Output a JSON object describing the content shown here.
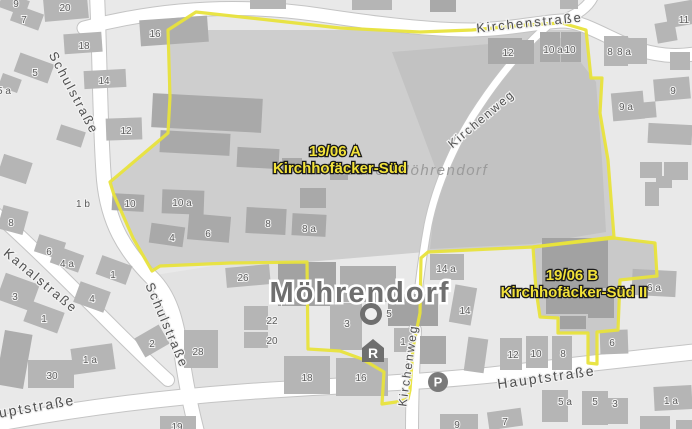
{
  "map": {
    "palette": {
      "background": "#e9e9e9",
      "field_main": "#cecece",
      "field_dark": "#c2c2c2",
      "field_b": "#c9c9c9",
      "village_tint": "#e2e2e2",
      "road_fill": "#ffffff",
      "road_casing": "#c4c4c4",
      "building_fills": [
        "#b5b5b5",
        "#a9a9a9",
        "#a2a2a2",
        "#adadad"
      ],
      "boundary_yellow": "#e8e33c",
      "zone_label_yellow": "#f2e23a",
      "zone_label_outline": "#1a1a1a",
      "street_text": "#4f4f4f",
      "number_text": "#5c5c5c",
      "town_text": "#6f6f6f",
      "cemetery_text": "#9b9b9b",
      "icon_gray": "#6f6f6f",
      "halo": "#f2f2f2"
    },
    "zones": [
      {
        "id": "a",
        "label_line1": "19/06 A",
        "label_line2": "Kirchhofäcker-Süd",
        "label_x1": 335,
        "label_y1": 156,
        "label_x2": 340,
        "label_y2": 173,
        "points": "196,12 260,19 340,28 420,32 472,30 525,25 562,23 586,30 591,78 602,78 600,113 608,160 614,237 533,247 470,250 428,252 421,258 420,313 413,348 410,390 408,399 396,402 382,404 384,372 362,359 340,351 308,349 307,262 230,263 160,266 152,271 133,238 114,195 110,182 168,133 170,97 168,30"
      },
      {
        "id": "b",
        "label_line1": "19/06 B",
        "label_line2": "Kirchhofäcker-Süd II",
        "label_x1": 572,
        "label_y1": 280,
        "label_x2": 574,
        "label_y2": 297,
        "points": "533,247 614,238 655,243 657,276 620,280 618,330 597,332 597,364 588,363 588,333 558,333 558,318 540,317 536,290"
      }
    ],
    "fields": [
      {
        "name": "field-a-north",
        "fill_key": "field_main",
        "points": "168,30 586,30 591,78 602,78 600,113 608,160 614,237 533,247 470,250 425,252 307,262 230,263 160,266 152,271 133,238 114,195 110,182 168,133"
      },
      {
        "name": "field-a-dark",
        "fill_key": "field_dark",
        "points": "392,52 562,38 596,82 602,160 606,232 533,244 470,247 430,249 438,175 410,100"
      },
      {
        "name": "field-b",
        "fill_key": "field_b",
        "points": "533,247 614,238 655,243 657,276 620,280 618,330 597,332 597,364 588,363 588,333 558,333 558,318 540,317 536,290"
      },
      {
        "name": "village-block",
        "fill_key": "village_tint",
        "points": "232,263 307,263 308,350 342,352 364,361 386,373 384,404 408,400 410,430 198,432 178,340 155,275"
      }
    ],
    "roads": [
      {
        "name": "schulstrasse",
        "w": 14,
        "d": "M 97,-6 C 100,60 100,130 104,180 C 108,222 124,250 152,278 C 170,296 176,320 181,350 C 185,378 190,405 197,432"
      },
      {
        "name": "kirchenstrasse",
        "w": 13,
        "d": "M 84,28 C 160,8 240,3 320,15 C 380,24 430,30 472,30 C 512,29 540,22 562,21 C 585,21 610,40 640,50 C 665,57 680,56 694,54"
      },
      {
        "name": "kirchenstrasse-branch",
        "w": 10,
        "d": "M 560,21 C 576,16 590,6 594,-6"
      },
      {
        "name": "kirchenweg",
        "w": 7,
        "d": "M 552,22 C 528,42 502,72 480,105 C 456,140 436,185 428,225 C 422,258 417,300 414,332 C 412,372 411,400 411,432"
      },
      {
        "name": "kirchenweg-lower",
        "w": 12,
        "d": "M 415,330 C 413,370 412,400 412,432"
      },
      {
        "name": "kanalstrasse",
        "w": 12,
        "d": "M -6,212 C 30,244 72,286 106,320 C 128,342 148,362 168,380"
      },
      {
        "name": "hauptstrasse",
        "w": 15,
        "d": "M -6,424 C 80,408 160,398 242,392 C 322,386 420,383 500,374 C 580,364 640,358 694,352"
      }
    ],
    "buildings": [
      [
        0,
        -4,
        28,
        16,
        20,
        0
      ],
      [
        12,
        9,
        30,
        17,
        20,
        0
      ],
      [
        44,
        -2,
        44,
        22,
        -5,
        0
      ],
      [
        16,
        58,
        36,
        20,
        20,
        0
      ],
      [
        0,
        76,
        20,
        14,
        20,
        0
      ],
      [
        64,
        33,
        38,
        20,
        -4,
        0
      ],
      [
        140,
        18,
        68,
        26,
        -4,
        3
      ],
      [
        84,
        70,
        42,
        18,
        -3,
        0
      ],
      [
        106,
        118,
        36,
        22,
        -2,
        0
      ],
      [
        250,
        0,
        36,
        9,
        0,
        0
      ],
      [
        352,
        0,
        40,
        10,
        0,
        0
      ],
      [
        430,
        0,
        26,
        12,
        0,
        1
      ],
      [
        560,
        0,
        18,
        9,
        0,
        0
      ],
      [
        112,
        194,
        32,
        17,
        3,
        1
      ],
      [
        162,
        190,
        42,
        24,
        2,
        1
      ],
      [
        150,
        225,
        34,
        20,
        8,
        1
      ],
      [
        188,
        215,
        42,
        26,
        5,
        1
      ],
      [
        246,
        208,
        40,
        26,
        3,
        1
      ],
      [
        292,
        214,
        34,
        22,
        3,
        1
      ],
      [
        152,
        96,
        110,
        34,
        3,
        1
      ],
      [
        160,
        132,
        70,
        22,
        3,
        1
      ],
      [
        237,
        148,
        42,
        20,
        3,
        1
      ],
      [
        282,
        158,
        20,
        14,
        0,
        1
      ],
      [
        300,
        188,
        26,
        20,
        0,
        1
      ],
      [
        330,
        166,
        18,
        14,
        0,
        1
      ],
      [
        488,
        38,
        34,
        26,
        0,
        1
      ],
      [
        522,
        40,
        12,
        24,
        0,
        1
      ],
      [
        540,
        32,
        20,
        30,
        0,
        1
      ],
      [
        561,
        32,
        20,
        30,
        0,
        1
      ],
      [
        604,
        36,
        24,
        30,
        0,
        0
      ],
      [
        623,
        38,
        24,
        26,
        0,
        0
      ],
      [
        666,
        2,
        28,
        24,
        -10,
        0
      ],
      [
        656,
        22,
        20,
        20,
        -10,
        0
      ],
      [
        670,
        52,
        20,
        18,
        0,
        0
      ],
      [
        654,
        78,
        36,
        22,
        -5,
        0
      ],
      [
        612,
        92,
        32,
        28,
        -5,
        0
      ],
      [
        640,
        102,
        16,
        16,
        -5,
        0
      ],
      [
        648,
        124,
        44,
        20,
        3,
        0
      ],
      [
        640,
        162,
        22,
        16,
        0,
        0
      ],
      [
        664,
        162,
        24,
        18,
        0,
        0
      ],
      [
        656,
        176,
        16,
        12,
        0,
        0
      ],
      [
        645,
        182,
        14,
        24,
        0,
        0
      ],
      [
        542,
        238,
        66,
        50,
        0,
        2
      ],
      [
        546,
        286,
        46,
        28,
        0,
        2
      ],
      [
        588,
        296,
        26,
        22,
        0,
        2
      ],
      [
        560,
        316,
        26,
        13,
        0,
        2
      ],
      [
        632,
        270,
        44,
        26,
        3,
        0
      ],
      [
        600,
        330,
        28,
        24,
        -2,
        0
      ],
      [
        226,
        266,
        44,
        20,
        -5,
        0
      ],
      [
        244,
        306,
        24,
        24,
        0,
        0
      ],
      [
        244,
        332,
        24,
        16,
        0,
        0
      ],
      [
        278,
        262,
        58,
        44,
        0,
        2
      ],
      [
        340,
        266,
        56,
        36,
        0,
        3
      ],
      [
        330,
        303,
        32,
        47,
        0,
        0
      ],
      [
        388,
        294,
        50,
        32,
        0,
        2
      ],
      [
        394,
        328,
        18,
        24,
        0,
        0
      ],
      [
        430,
        254,
        34,
        26,
        0,
        0
      ],
      [
        452,
        286,
        22,
        38,
        10,
        0
      ],
      [
        284,
        356,
        46,
        38,
        0,
        0
      ],
      [
        336,
        358,
        52,
        38,
        0,
        0
      ],
      [
        420,
        336,
        26,
        28,
        0,
        1
      ],
      [
        466,
        338,
        20,
        34,
        8,
        0
      ],
      [
        500,
        338,
        22,
        32,
        0,
        0
      ],
      [
        526,
        336,
        22,
        32,
        0,
        0
      ],
      [
        552,
        336,
        20,
        34,
        0,
        0
      ],
      [
        440,
        414,
        38,
        15,
        0,
        0
      ],
      [
        488,
        410,
        34,
        18,
        -8,
        0
      ],
      [
        542,
        390,
        26,
        32,
        0,
        0
      ],
      [
        582,
        391,
        26,
        34,
        0,
        0
      ],
      [
        608,
        398,
        20,
        26,
        0,
        0
      ],
      [
        654,
        386,
        38,
        24,
        -3,
        0
      ],
      [
        640,
        416,
        30,
        13,
        0,
        0
      ],
      [
        676,
        420,
        18,
        9,
        0,
        0
      ],
      [
        0,
        278,
        36,
        28,
        20,
        0
      ],
      [
        52,
        250,
        30,
        18,
        20,
        0
      ],
      [
        98,
        260,
        32,
        20,
        20,
        0
      ],
      [
        76,
        286,
        32,
        22,
        20,
        0
      ],
      [
        26,
        306,
        36,
        22,
        20,
        0
      ],
      [
        72,
        346,
        42,
        26,
        -8,
        0
      ],
      [
        28,
        360,
        46,
        28,
        0,
        0
      ],
      [
        0,
        332,
        28,
        55,
        10,
        3
      ],
      [
        138,
        330,
        28,
        22,
        -30,
        0
      ],
      [
        184,
        330,
        34,
        38,
        0,
        0
      ],
      [
        160,
        416,
        36,
        13,
        0,
        0
      ],
      [
        0,
        208,
        26,
        24,
        15,
        0
      ],
      [
        36,
        238,
        28,
        18,
        18,
        0
      ],
      [
        0,
        158,
        30,
        22,
        18,
        0
      ],
      [
        58,
        128,
        26,
        16,
        18,
        0
      ]
    ],
    "house_numbers": [
      [
        "9",
        16,
        3
      ],
      [
        "20",
        65,
        7
      ],
      [
        "7",
        24,
        19
      ],
      [
        "16",
        155,
        33
      ],
      [
        "18",
        84,
        45
      ],
      [
        "5",
        35,
        72
      ],
      [
        "14",
        104,
        80
      ],
      [
        "5 a",
        4,
        90
      ],
      [
        "12",
        126,
        130
      ],
      [
        "1 b",
        83,
        203
      ],
      [
        "10",
        130,
        203
      ],
      [
        "10 a",
        182,
        202
      ],
      [
        "4",
        172,
        237
      ],
      [
        "6",
        208,
        233
      ],
      [
        "8",
        268,
        223
      ],
      [
        "8 a",
        309,
        228
      ],
      [
        "8",
        11,
        222
      ],
      [
        "6",
        49,
        251
      ],
      [
        "4 a",
        67,
        263
      ],
      [
        "1",
        113,
        274
      ],
      [
        "3",
        15,
        296
      ],
      [
        "4",
        92,
        298
      ],
      [
        "1",
        44,
        318
      ],
      [
        "1 a",
        90,
        359
      ],
      [
        "30",
        52,
        375
      ],
      [
        "2",
        152,
        343
      ],
      [
        "28",
        198,
        351
      ],
      [
        "19",
        177,
        426
      ],
      [
        "12",
        508,
        52
      ],
      [
        "10 a",
        553,
        49
      ],
      [
        "10",
        570,
        49
      ],
      [
        "8",
        610,
        51
      ],
      [
        "8 a",
        624,
        51
      ],
      [
        "11",
        684,
        19
      ],
      [
        "9",
        673,
        90
      ],
      [
        "9 a",
        626,
        106
      ],
      [
        "26",
        243,
        277
      ],
      [
        "22",
        272,
        320
      ],
      [
        "20",
        272,
        340
      ],
      [
        "3",
        347,
        323
      ],
      [
        "5",
        389,
        313
      ],
      [
        "1",
        403,
        341
      ],
      [
        "14 a",
        446,
        268
      ],
      [
        "14",
        465,
        310
      ],
      [
        "18",
        307,
        377
      ],
      [
        "16",
        361,
        377
      ],
      [
        "6 a",
        654,
        287
      ],
      [
        "12",
        513,
        354
      ],
      [
        "10",
        536,
        353
      ],
      [
        "8",
        563,
        353
      ],
      [
        "6",
        612,
        342
      ],
      [
        "5 a",
        565,
        401
      ],
      [
        "5",
        595,
        401
      ],
      [
        "3",
        615,
        403
      ],
      [
        "1 a",
        671,
        400
      ],
      [
        "9",
        457,
        424
      ],
      [
        "7",
        505,
        421
      ]
    ],
    "street_labels": [
      [
        "Schulstraße",
        70,
        95,
        62,
        13
      ],
      [
        "Schulstraße",
        163,
        327,
        67,
        13
      ],
      [
        "Kanalstraße",
        38,
        284,
        40,
        13
      ],
      [
        "Kirchenstraße",
        530,
        27,
        -6,
        13
      ],
      [
        "Kirchenweg",
        484,
        122,
        -40,
        12
      ],
      [
        "Kirchenweg",
        412,
        366,
        -82,
        12
      ],
      [
        "Hauptstraße",
        547,
        382,
        -8,
        14
      ],
      [
        "Hauptstraße",
        27,
        413,
        -10,
        14
      ]
    ],
    "place_labels": {
      "town": {
        "text": "Möhrendorf",
        "x": 360,
        "y": 302,
        "size": 29
      },
      "cemetery": {
        "text": "Friedhof Möhrendorf",
        "x": 406,
        "y": 175,
        "size": 15
      }
    },
    "pois": {
      "rathaus": {
        "letter": "R",
        "x": 373,
        "y": 351
      },
      "parking": {
        "letter": "P",
        "x": 438,
        "y": 382
      },
      "ring": {
        "x": 371,
        "y": 314
      }
    }
  }
}
